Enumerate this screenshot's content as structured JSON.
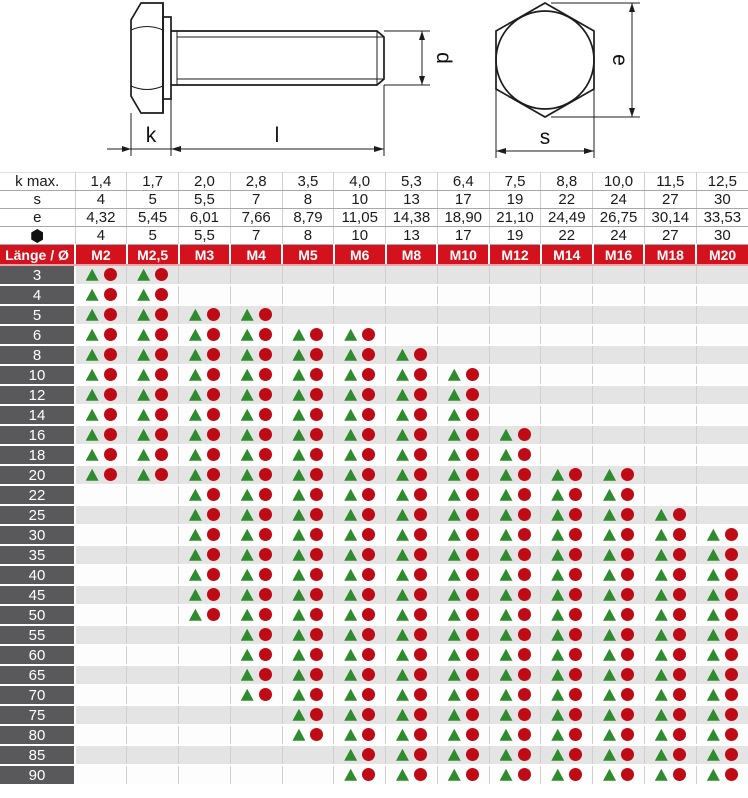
{
  "title": "Sechskantschraube Abmessungen",
  "diagram": {
    "side_view": {
      "labels": {
        "k": "k",
        "l": "l",
        "d": "d"
      }
    },
    "head_view": {
      "labels": {
        "e": "e",
        "s": "s"
      }
    }
  },
  "table": {
    "dim_rows": [
      {
        "key": "k-max",
        "label": "k max.",
        "values": [
          "1,4",
          "1,7",
          "2,0",
          "2,8",
          "3,5",
          "4,0",
          "5,3",
          "6,4",
          "7,5",
          "8,8",
          "10,0",
          "11,5",
          "12,5"
        ]
      },
      {
        "key": "s",
        "label": "s",
        "values": [
          "4",
          "5",
          "5,5",
          "7",
          "8",
          "10",
          "13",
          "17",
          "19",
          "22",
          "24",
          "27",
          "30"
        ]
      },
      {
        "key": "e",
        "label": "e",
        "values": [
          "4,32",
          "5,45",
          "6,01",
          "7,66",
          "8,79",
          "11,05",
          "14,38",
          "18,90",
          "21,10",
          "24,49",
          "26,75",
          "30,14",
          "33,53"
        ]
      },
      {
        "key": "wrench",
        "label": "",
        "icon": "hexagon-icon",
        "values": [
          "4",
          "5",
          "5,5",
          "7",
          "8",
          "10",
          "13",
          "17",
          "19",
          "22",
          "24",
          "27",
          "30"
        ]
      }
    ],
    "size_row": {
      "label": "Länge / Ø",
      "columns": [
        "M2",
        "M2,5",
        "M3",
        "M4",
        "M5",
        "M6",
        "M8",
        "M10",
        "M12",
        "M14",
        "M16",
        "M18",
        "M20"
      ]
    },
    "rows": [
      {
        "length": "3",
        "available": [
          1,
          1,
          0,
          0,
          0,
          0,
          0,
          0,
          0,
          0,
          0,
          0,
          0
        ]
      },
      {
        "length": "4",
        "available": [
          1,
          1,
          0,
          0,
          0,
          0,
          0,
          0,
          0,
          0,
          0,
          0,
          0
        ]
      },
      {
        "length": "5",
        "available": [
          1,
          1,
          1,
          1,
          0,
          0,
          0,
          0,
          0,
          0,
          0,
          0,
          0
        ]
      },
      {
        "length": "6",
        "available": [
          1,
          1,
          1,
          1,
          1,
          1,
          0,
          0,
          0,
          0,
          0,
          0,
          0
        ]
      },
      {
        "length": "8",
        "available": [
          1,
          1,
          1,
          1,
          1,
          1,
          1,
          0,
          0,
          0,
          0,
          0,
          0
        ]
      },
      {
        "length": "10",
        "available": [
          1,
          1,
          1,
          1,
          1,
          1,
          1,
          1,
          0,
          0,
          0,
          0,
          0
        ]
      },
      {
        "length": "12",
        "available": [
          1,
          1,
          1,
          1,
          1,
          1,
          1,
          1,
          0,
          0,
          0,
          0,
          0
        ]
      },
      {
        "length": "14",
        "available": [
          1,
          1,
          1,
          1,
          1,
          1,
          1,
          1,
          0,
          0,
          0,
          0,
          0
        ]
      },
      {
        "length": "16",
        "available": [
          1,
          1,
          1,
          1,
          1,
          1,
          1,
          1,
          1,
          0,
          0,
          0,
          0
        ]
      },
      {
        "length": "18",
        "available": [
          1,
          1,
          1,
          1,
          1,
          1,
          1,
          1,
          1,
          0,
          0,
          0,
          0
        ]
      },
      {
        "length": "20",
        "available": [
          1,
          1,
          1,
          1,
          1,
          1,
          1,
          1,
          1,
          1,
          1,
          0,
          0
        ]
      },
      {
        "length": "22",
        "available": [
          0,
          0,
          1,
          1,
          1,
          1,
          1,
          1,
          1,
          1,
          1,
          0,
          0
        ]
      },
      {
        "length": "25",
        "available": [
          0,
          0,
          1,
          1,
          1,
          1,
          1,
          1,
          1,
          1,
          1,
          1,
          0
        ]
      },
      {
        "length": "30",
        "available": [
          0,
          0,
          1,
          1,
          1,
          1,
          1,
          1,
          1,
          1,
          1,
          1,
          1
        ]
      },
      {
        "length": "35",
        "available": [
          0,
          0,
          1,
          1,
          1,
          1,
          1,
          1,
          1,
          1,
          1,
          1,
          1
        ]
      },
      {
        "length": "40",
        "available": [
          0,
          0,
          1,
          1,
          1,
          1,
          1,
          1,
          1,
          1,
          1,
          1,
          1
        ]
      },
      {
        "length": "45",
        "available": [
          0,
          0,
          1,
          1,
          1,
          1,
          1,
          1,
          1,
          1,
          1,
          1,
          1
        ]
      },
      {
        "length": "50",
        "available": [
          0,
          0,
          1,
          1,
          1,
          1,
          1,
          1,
          1,
          1,
          1,
          1,
          1
        ]
      },
      {
        "length": "55",
        "available": [
          0,
          0,
          0,
          1,
          1,
          1,
          1,
          1,
          1,
          1,
          1,
          1,
          1
        ]
      },
      {
        "length": "60",
        "available": [
          0,
          0,
          0,
          1,
          1,
          1,
          1,
          1,
          1,
          1,
          1,
          1,
          1
        ]
      },
      {
        "length": "65",
        "available": [
          0,
          0,
          0,
          1,
          1,
          1,
          1,
          1,
          1,
          1,
          1,
          1,
          1
        ]
      },
      {
        "length": "70",
        "available": [
          0,
          0,
          0,
          1,
          1,
          1,
          1,
          1,
          1,
          1,
          1,
          1,
          1
        ]
      },
      {
        "length": "75",
        "available": [
          0,
          0,
          0,
          0,
          1,
          1,
          1,
          1,
          1,
          1,
          1,
          1,
          1
        ]
      },
      {
        "length": "80",
        "available": [
          0,
          0,
          0,
          0,
          1,
          1,
          1,
          1,
          1,
          1,
          1,
          1,
          1
        ]
      },
      {
        "length": "85",
        "available": [
          0,
          0,
          0,
          0,
          0,
          1,
          1,
          1,
          1,
          1,
          1,
          1,
          1
        ]
      },
      {
        "length": "90",
        "available": [
          0,
          0,
          0,
          0,
          0,
          1,
          1,
          1,
          1,
          1,
          1,
          1,
          1
        ]
      }
    ],
    "markers": {
      "available": [
        "triangle",
        "circle"
      ]
    }
  },
  "colors": {
    "header_red": "#d4121e",
    "header_red_underline": "#f4a2a8",
    "row_label_bg": "#59595b",
    "row_alt_bg": "#e4e4e4",
    "grid_line": "#cfcfcf",
    "triangle_green": "#2e8b2e",
    "circle_red": "#bf0b16"
  }
}
